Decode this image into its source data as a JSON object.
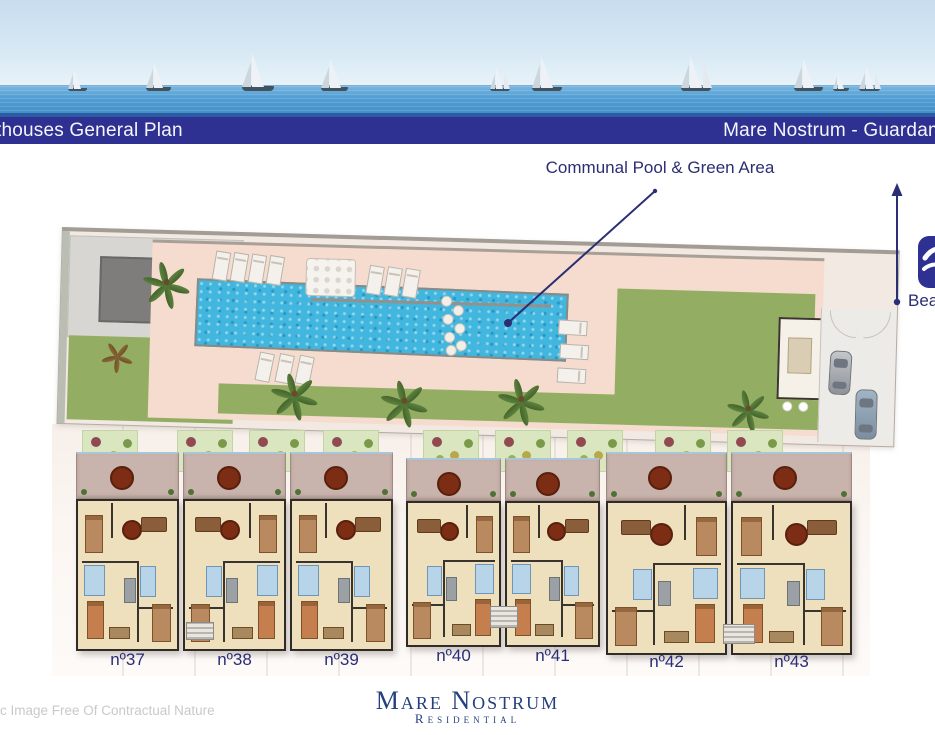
{
  "header": {
    "left_title": "thouses General Plan",
    "right_title": "Mare Nostrum - Guardam"
  },
  "plan_annotation": {
    "label": "Communal Pool & Green Area"
  },
  "beach": {
    "label": "Bea",
    "icon": "beach-wave-icon"
  },
  "units": [
    {
      "label": "nº37"
    },
    {
      "label": "nº38"
    },
    {
      "label": "nº39"
    },
    {
      "label": "nº40"
    },
    {
      "label": "nº41"
    },
    {
      "label": "nº42"
    },
    {
      "label": "nº43"
    }
  ],
  "footer": {
    "brand_name": "Mare Nostrum",
    "brand_subtitle": "Residential",
    "disclaimer": "ic Image Free Of Contractual Nature"
  },
  "colors": {
    "banner_navy": "#2e3192",
    "annotation_navy": "#2b2e73",
    "pool_blue": "#41b6de",
    "lawn_green": "#93ae62",
    "deck_pink": "#f5dccf",
    "floorplan_beige": "#eee0bd",
    "bathroom_blue": "#b7d4e9",
    "terrace_mauve": "#c9b3ad"
  }
}
